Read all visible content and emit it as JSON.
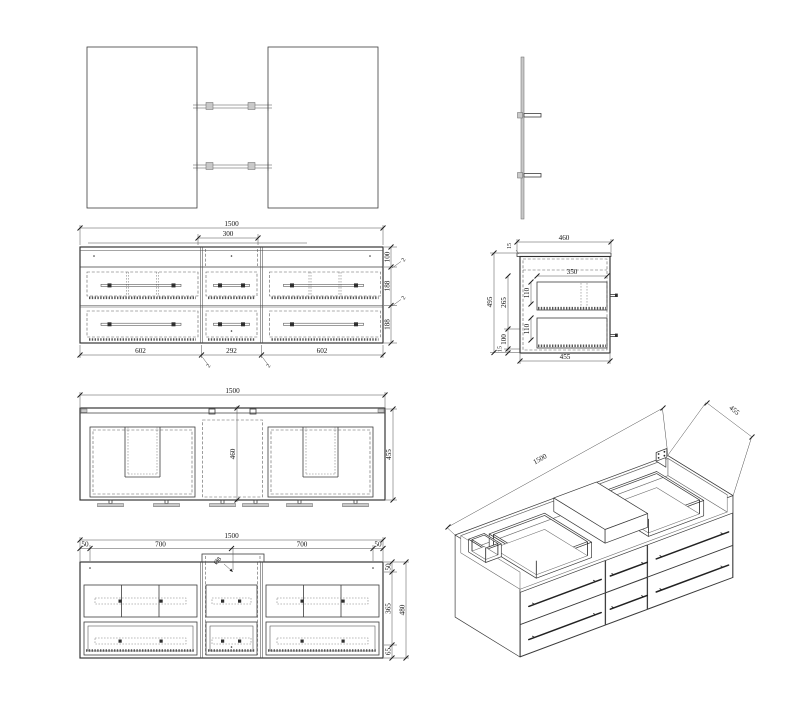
{
  "drawing_title": "vanity cabinet technical drawing",
  "views": {
    "mirror_front": {
      "name": "mirror front view"
    },
    "mirror_side": {
      "name": "mirror side view"
    },
    "front": {
      "w1500": "1500",
      "w300": "300",
      "h100": "100",
      "g2_top": "2",
      "h188_1": "188",
      "g2_mid": "2",
      "h188_2": "188",
      "w602_l": "602",
      "w292": "292",
      "w602_r": "602",
      "g2_b1": "2",
      "g2_b2": "2"
    },
    "side": {
      "w460": "460",
      "t15_top": "15",
      "w350": "350",
      "h110_1": "110",
      "h110_2": "110",
      "h265": "265",
      "h100": "100",
      "t15_bot": "15",
      "h495": "495",
      "w455": "455"
    },
    "plan": {
      "w1500": "1500",
      "d460": "460",
      "d455": "455"
    },
    "bottom": {
      "w1500": "1500",
      "e50_l": "50",
      "s700_l": "700",
      "s700_r": "700",
      "e50_r": "50",
      "v50": "50",
      "v365": "365",
      "v65": "65",
      "v480": "480",
      "hole": "Ø8"
    },
    "iso": {
      "l1500": "1500",
      "d455": "455"
    }
  }
}
